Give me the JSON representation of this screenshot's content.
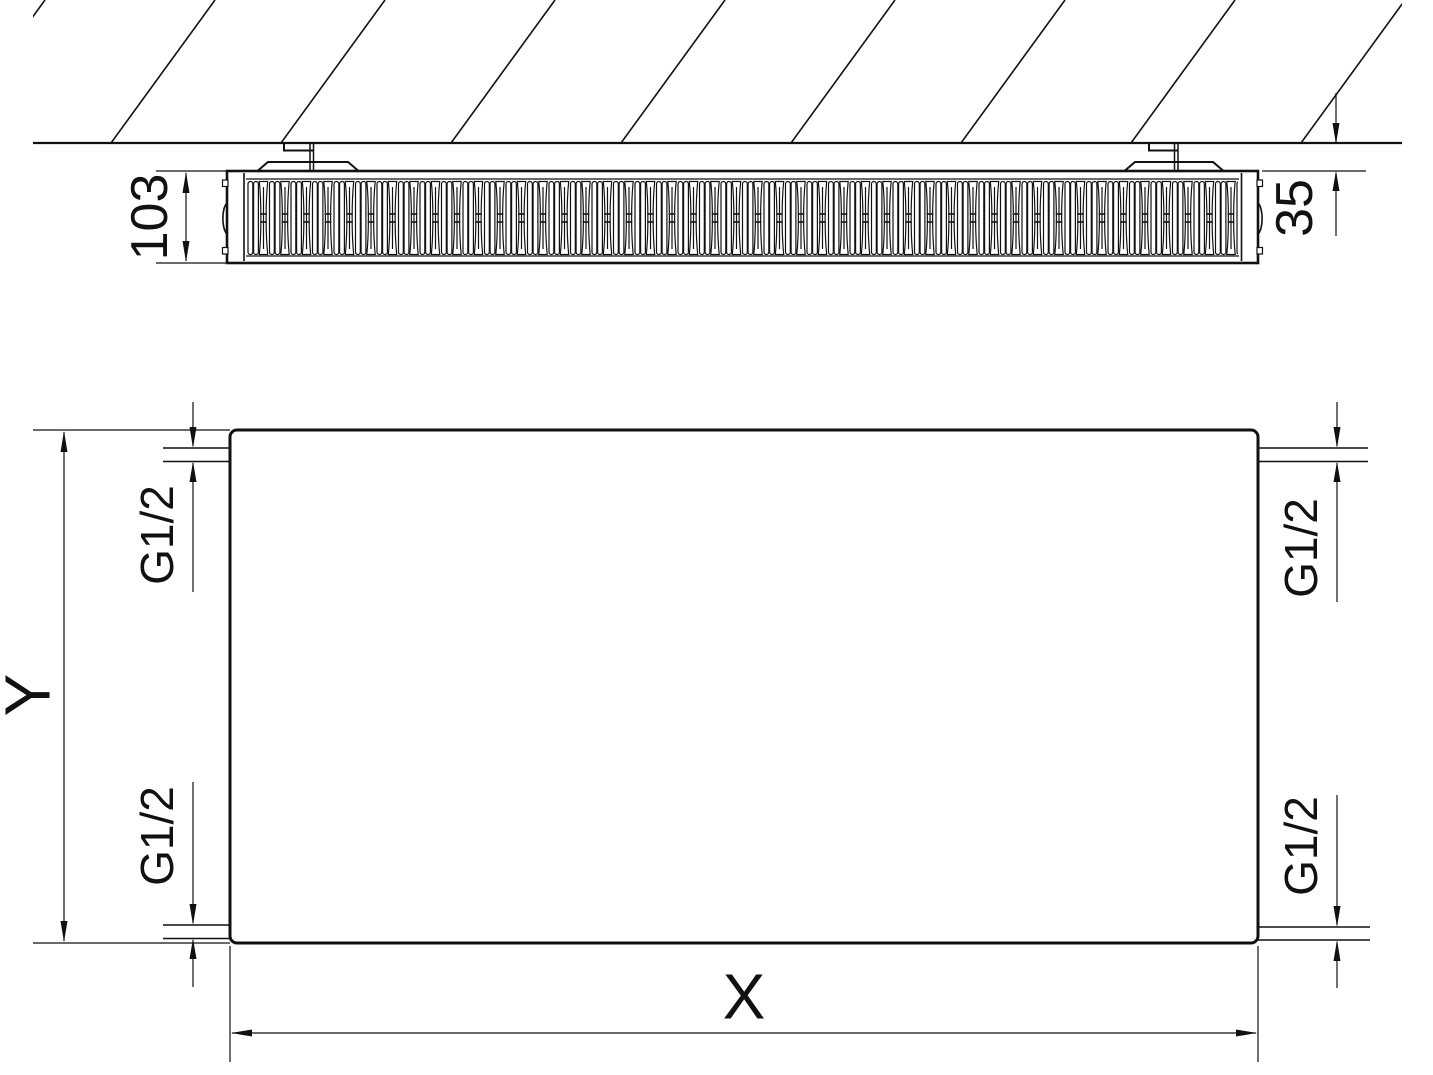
{
  "drawing": {
    "type": "radiator-technical-drawing",
    "views": {
      "top_view": "radiator horizontal section under wall",
      "front_view": "flat panel elevation"
    },
    "labels": {
      "depth": "103",
      "wall_distance": "35",
      "height": "Y",
      "width": "X",
      "conn_top_left": "G1/2",
      "conn_bottom_left": "G1/2",
      "conn_top_right": "G1/2",
      "conn_bottom_right": "G1/2"
    },
    "colors": {
      "line": "#111111",
      "background": "#ffffff"
    }
  }
}
